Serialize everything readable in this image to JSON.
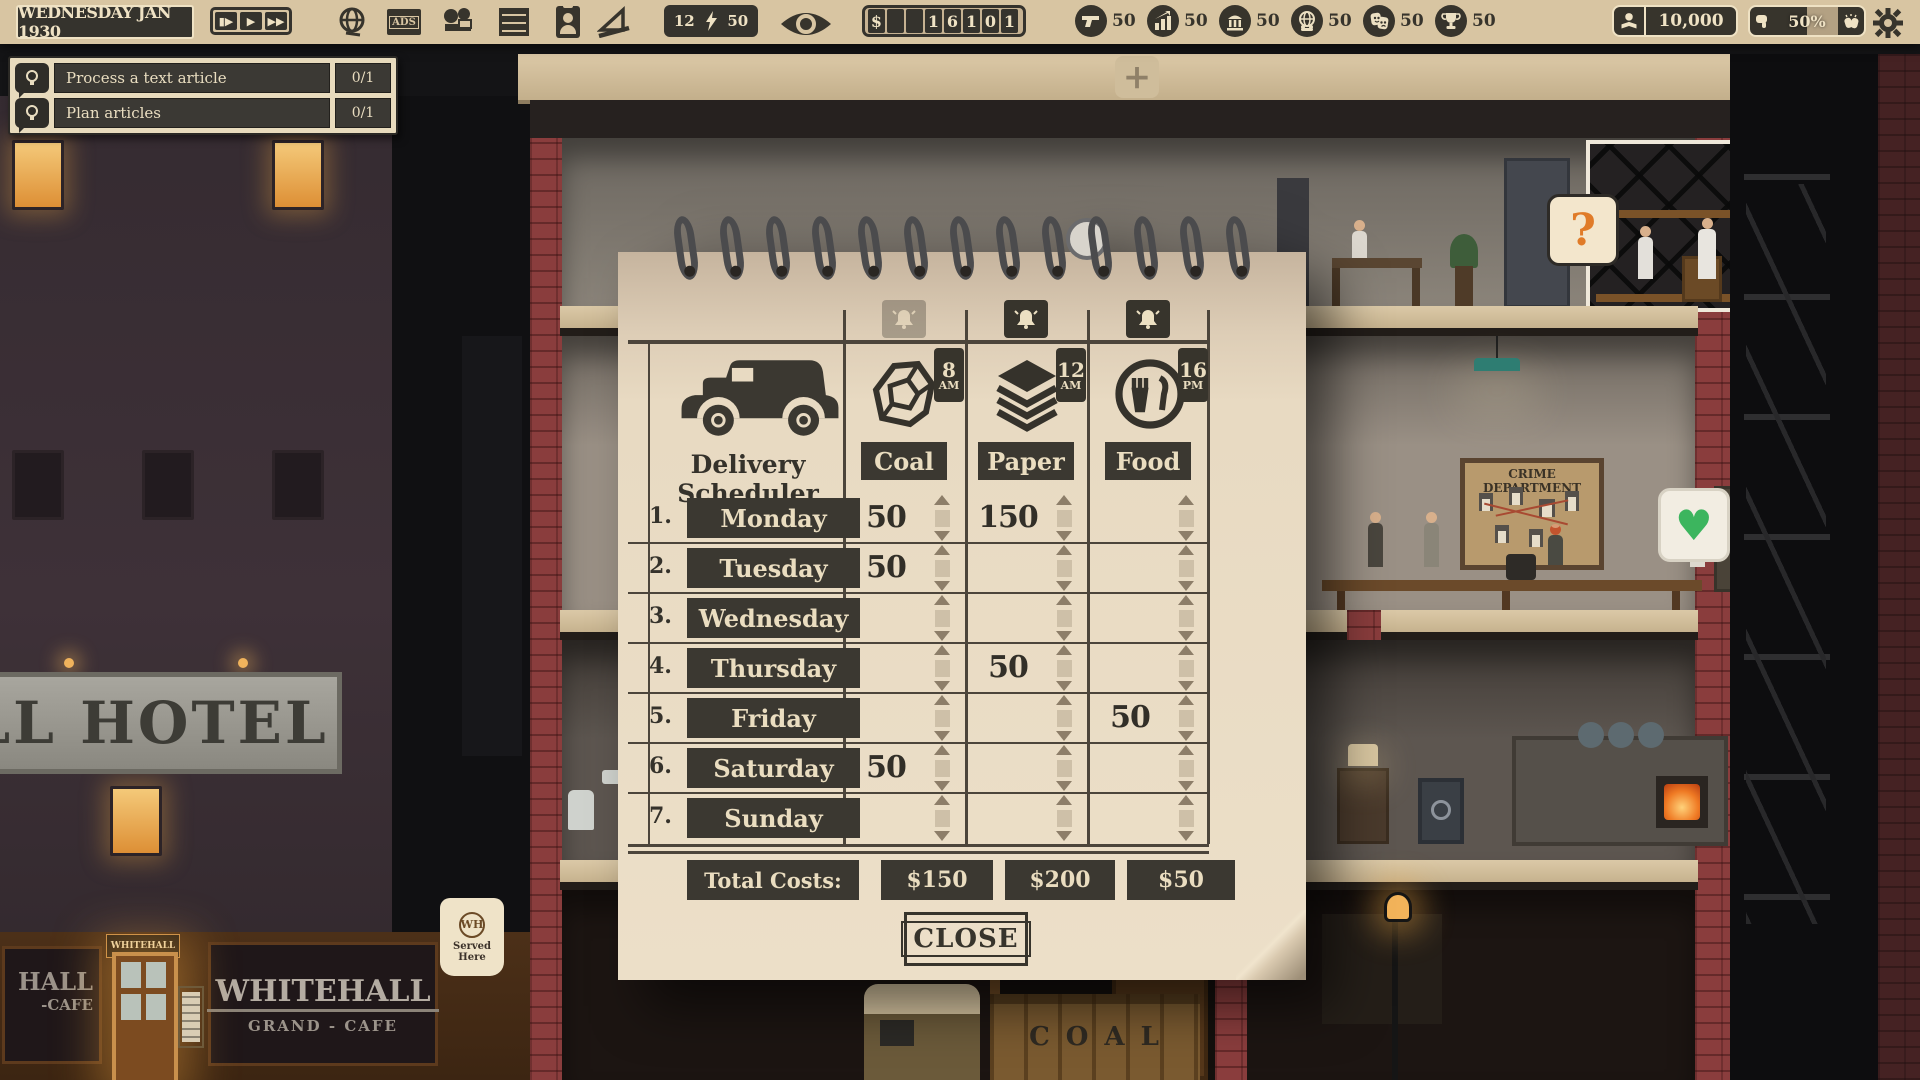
{
  "top_bar": {
    "date": "WEDNESDAY JAN 1930",
    "speed": {
      "b1": "▮▶",
      "b2": "▶",
      "b3": "▶▶"
    },
    "energy": {
      "left": "12",
      "right": "50"
    },
    "money": {
      "digits": [
        "$",
        "",
        "",
        "1",
        "6",
        "1",
        "0",
        "1"
      ]
    },
    "categories": [
      {
        "name": "crime",
        "value": "50"
      },
      {
        "name": "economy",
        "value": "50"
      },
      {
        "name": "politics",
        "value": "50"
      },
      {
        "name": "society",
        "value": "50"
      },
      {
        "name": "entertainment",
        "value": "50"
      },
      {
        "name": "sport",
        "value": "50"
      }
    ],
    "readers": "10,000",
    "approval": "50%"
  },
  "quests": {
    "items": [
      {
        "label": "Process a text article",
        "progress": "0/1"
      },
      {
        "label": "Plan articles",
        "progress": "0/1"
      }
    ]
  },
  "scheduler": {
    "title": "Delivery Scheduler",
    "columns": [
      {
        "label": "Coal",
        "time": "8",
        "meridiem": "AM"
      },
      {
        "label": "Paper",
        "time": "12",
        "meridiem": "AM"
      },
      {
        "label": "Food",
        "time": "16",
        "meridiem": "PM"
      }
    ],
    "rows": [
      {
        "num": "1.",
        "day": "Monday",
        "coal": "50",
        "paper": "150",
        "food": ""
      },
      {
        "num": "2.",
        "day": "Tuesday",
        "coal": "50",
        "paper": "",
        "food": ""
      },
      {
        "num": "3.",
        "day": "Wednesday",
        "coal": "",
        "paper": "",
        "food": ""
      },
      {
        "num": "4.",
        "day": "Thursday",
        "coal": "",
        "paper": "50",
        "food": ""
      },
      {
        "num": "5.",
        "day": "Friday",
        "coal": "",
        "paper": "",
        "food": "50"
      },
      {
        "num": "6.",
        "day": "Saturday",
        "coal": "50",
        "paper": "",
        "food": ""
      },
      {
        "num": "7.",
        "day": "Sunday",
        "coal": "",
        "paper": "",
        "food": ""
      }
    ],
    "totals": {
      "label": "Total Costs:",
      "coal": "$150",
      "paper": "$200",
      "food": "$50"
    },
    "close_label": "CLOSE"
  },
  "scene": {
    "hotel_sign": "LL HOTEL",
    "cafe": {
      "window_line1": "HALL",
      "window_line2": "-CAFE",
      "door_sign": "WHITEHALL",
      "name": "WHITEHALL",
      "subtitle": "GRAND - CAFE",
      "hanging_sign_top": "WH",
      "hanging_sign": "Served Here"
    },
    "crime_board_title": "CRIME DEPARTMENT",
    "coal_crate": "COAL",
    "question_bubble": "?",
    "heart_bubble": "♥",
    "plus_button": "+"
  }
}
